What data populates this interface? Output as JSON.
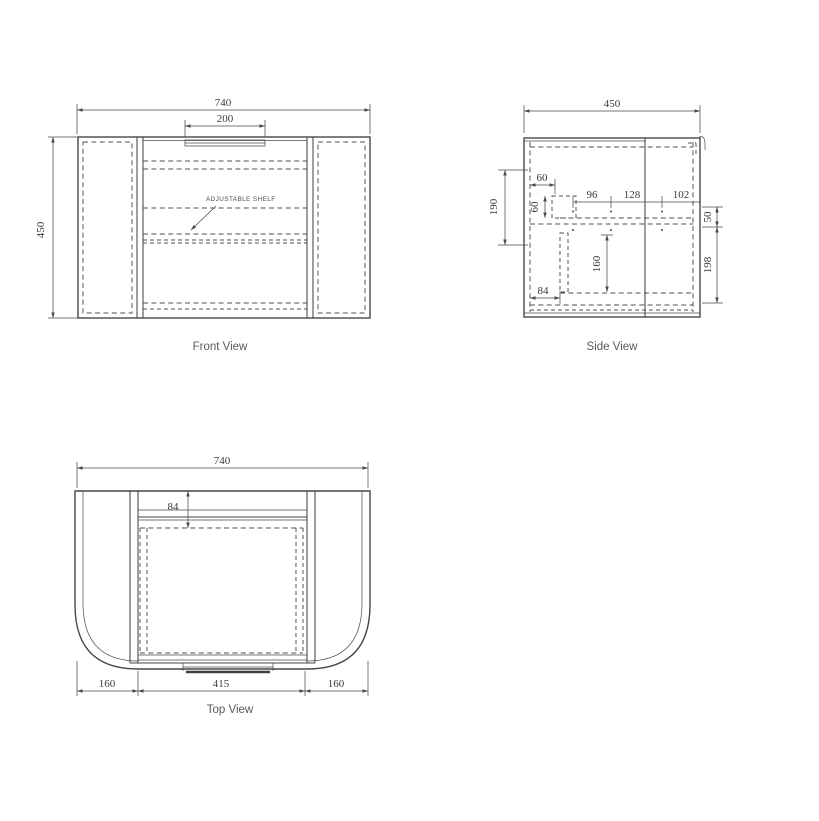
{
  "document": {
    "type": "cabinet technical drawing",
    "background_color": "#ffffff",
    "line_color": "#474747",
    "dimension_text_color": "#3a3a3a",
    "title_text_color": "#5a5a5a"
  },
  "front_view": {
    "title": "Front View",
    "width_dim": "740",
    "handle_dim": "200",
    "height_dim": "450",
    "shelf_note": "ADJUSTABLE SHELF"
  },
  "side_view": {
    "title": "Side View",
    "depth_dim": "450",
    "left_height_dim": "190",
    "hinge_inset_dim": "60",
    "hinge_plate_dim": "60",
    "spacing_a_dim": "96",
    "spacing_b_dim": "128",
    "spacing_c_dim": "102",
    "right_top_dim": "50",
    "right_bottom_dim": "198",
    "interior_dim": "160",
    "bottom_inset_dim": "84"
  },
  "top_view": {
    "title": "Top View",
    "width_dim": "740",
    "rail_depth_dim": "84",
    "left_wing_dim": "160",
    "opening_dim": "415",
    "right_wing_dim": "160"
  }
}
